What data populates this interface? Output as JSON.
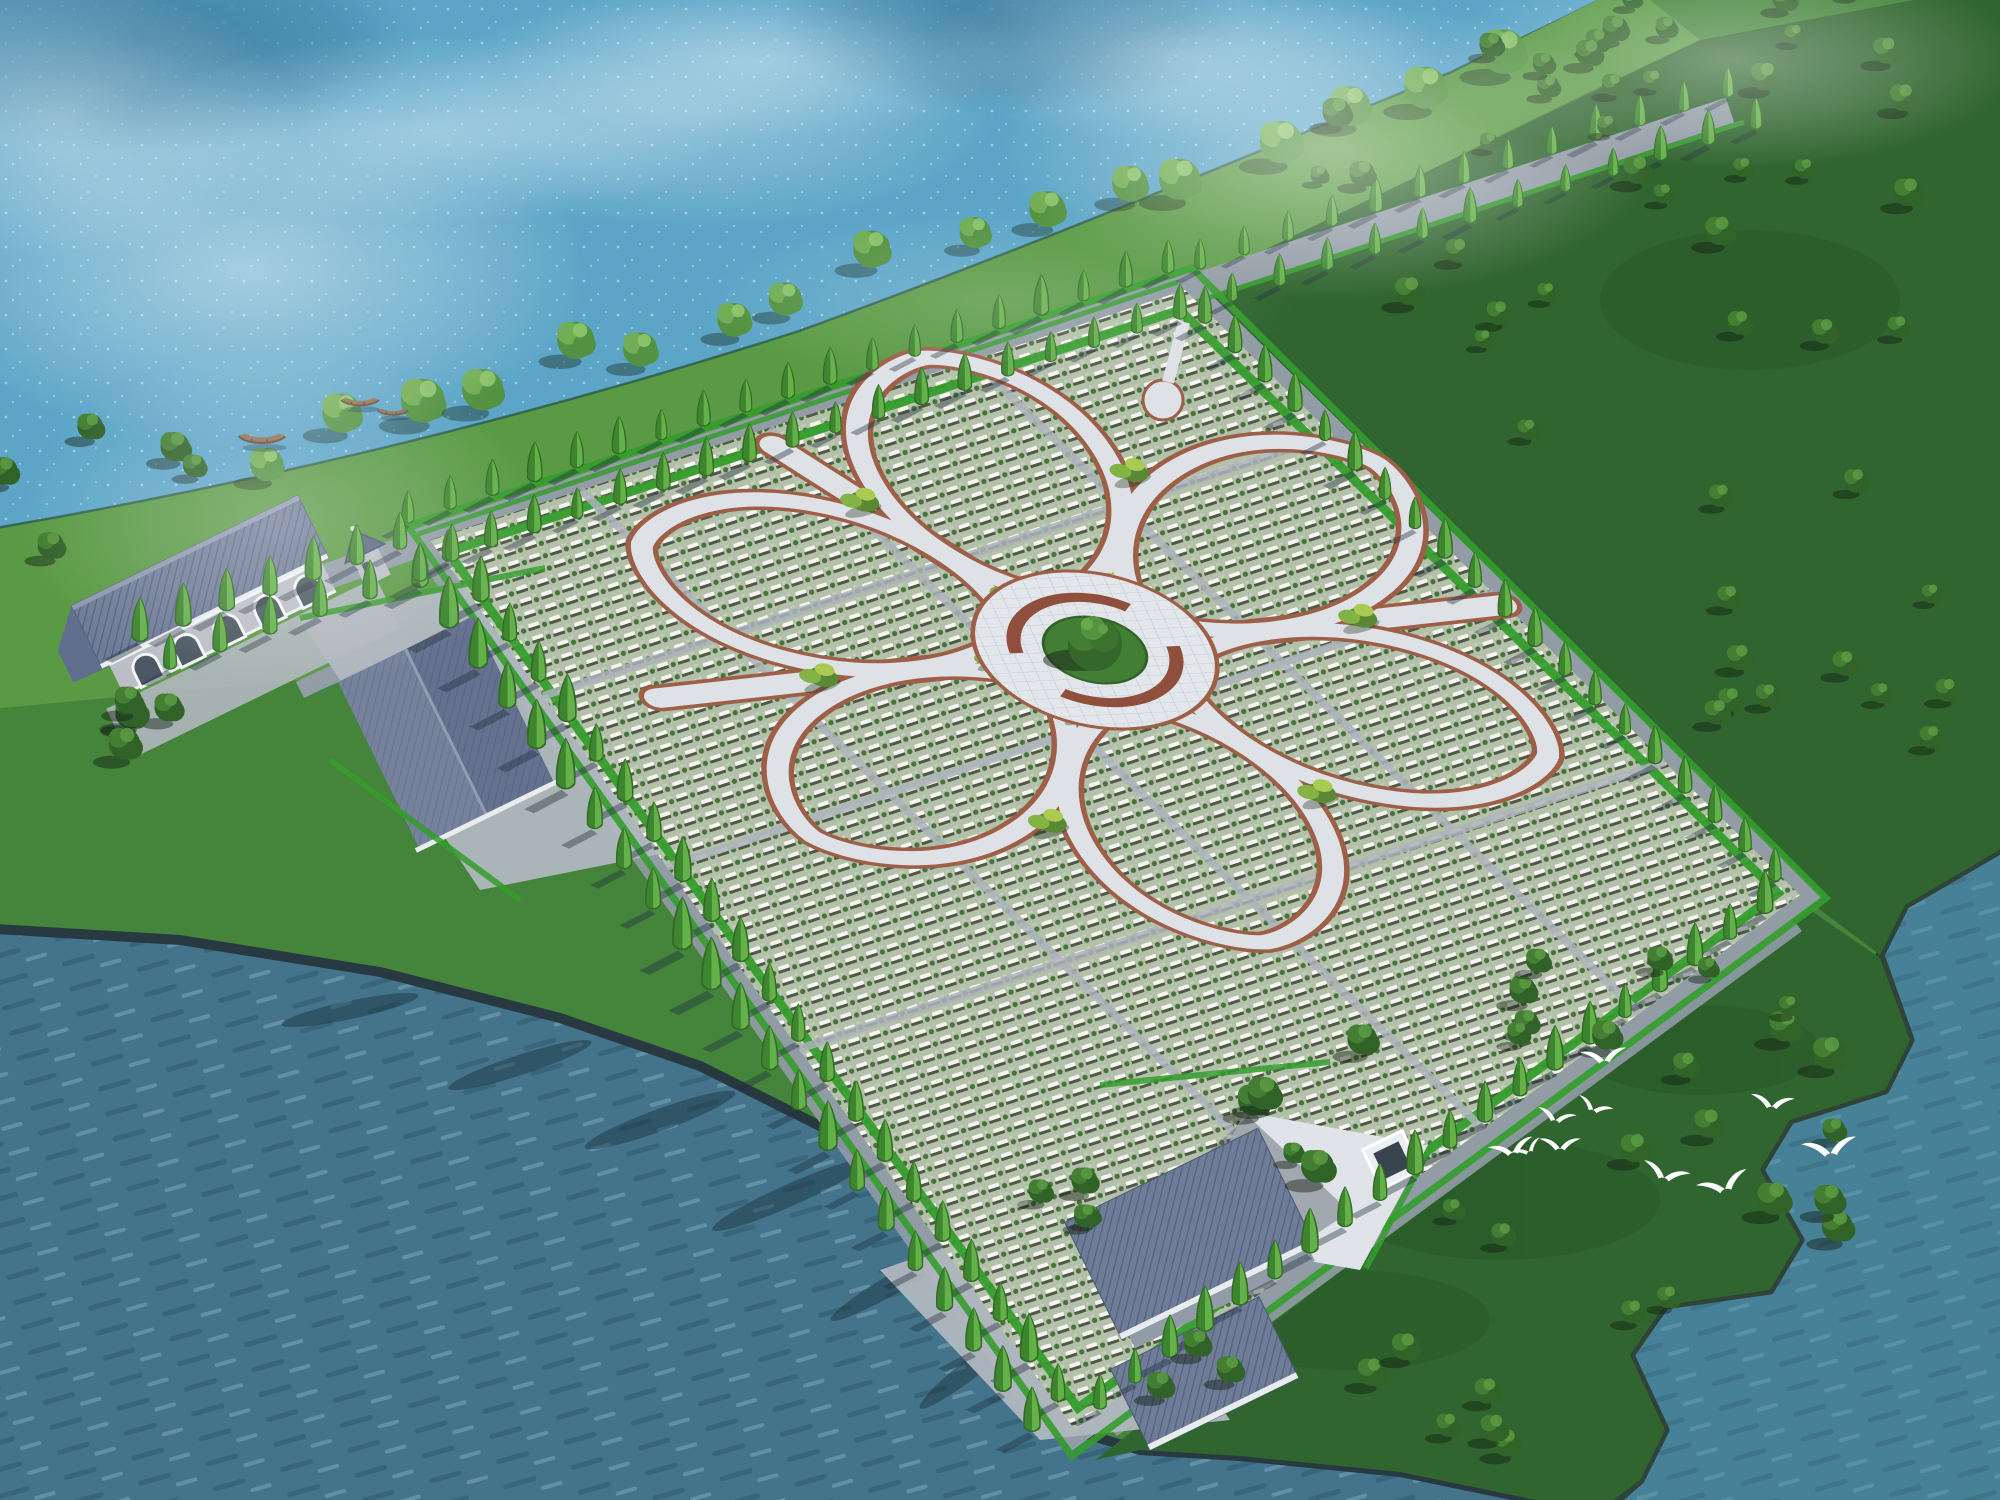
{
  "page": {
    "width": 2000,
    "height": 1500,
    "description": "Aerial 3D architectural rendering of a lakeside memorial park: a large diamond-shaped field of headstone rows with a six-petal flower path layout, circular central plaza with a memorial tree, perimeter roads lined with cypress trees, grey-roofed halls, boats on the lake and a flock of white egrets over the meadow"
  },
  "palette": {
    "water-light": "#58a3c6",
    "water-deep": "#3d7088",
    "water-teal": "#417d94",
    "land": "#3e8035",
    "grass-sunlit": "#55973f",
    "meadow-dark": "#2a6129",
    "field-base": "#b2bfa8",
    "stone-white": "#f3f5ee",
    "stone-shadow": "#26301f",
    "hedge": "#2f9a27",
    "cypress": "#3c8a2c",
    "cypress-dark": "#2c661f",
    "cypress-light": "#5fae44",
    "tree-dark": "#2b5e23",
    "tree-mid": "#3d7a2d",
    "tree-light": "#55963c",
    "shore-tree": "#4e8f3c",
    "shore-tree-light": "#6cab4e",
    "road": "#8e99a3",
    "path-light": "#dde2e7",
    "path-edge": "#9a5a42",
    "plaza-paving": "#e3e7eb",
    "planter": "#8d4937",
    "roof": "#6b7894",
    "roof-line": "#4f5c7a",
    "eave": "#e8ecef",
    "wall": "#b9bdc4",
    "window": "#46525e",
    "pave": "#aeb5bd",
    "court": "#dfe3e8",
    "boat": "#8a6a4a",
    "boat-dark": "#5e4430",
    "bird": "#ffffff",
    "coast-dark": "#22333b",
    "shoreline": "#2c5a50"
  },
  "features": {
    "flower_petals": 6,
    "central_plaza": "circular plaza with ring planters and one large memorial tree",
    "arched_windows_main_hall": 5,
    "bird_count": 10,
    "boat_count": 3,
    "water_bodies": [
      "calm lake upper left",
      "dark rippled river lower left",
      "bay lower right"
    ]
  },
  "scene_layout": {
    "cypress_rows": [
      {
        "x1": 408,
        "y1": 522,
        "x2": 1168,
        "y2": 272,
        "n": 19,
        "s": 0.95
      },
      {
        "x1": 448,
        "y1": 560,
        "x2": 1180,
        "y2": 318,
        "n": 18,
        "s": 0.9
      },
      {
        "x1": 1205,
        "y1": 322,
        "x2": 1775,
        "y2": 880,
        "n": 20,
        "s": 0.95
      },
      {
        "x1": 1200,
        "y1": 268,
        "x2": 1728,
        "y2": 96,
        "n": 13,
        "s": 0.85
      },
      {
        "x1": 1232,
        "y1": 300,
        "x2": 1756,
        "y2": 128,
        "n": 12,
        "s": 0.82
      },
      {
        "x1": 1765,
        "y1": 912,
        "x2": 1100,
        "y2": 1408,
        "n": 20,
        "s": 1.05
      },
      {
        "x1": 1058,
        "y1": 1400,
        "x2": 452,
        "y2": 560,
        "n": 22,
        "s": 1.12
      },
      {
        "x1": 1032,
        "y1": 1430,
        "x2": 420,
        "y2": 586,
        "n": 22,
        "s": 1.22
      },
      {
        "x1": 400,
        "y1": 548,
        "x2": 140,
        "y2": 640,
        "n": 7,
        "s": 1.1
      },
      {
        "x1": 420,
        "y1": 580,
        "x2": 170,
        "y2": 668,
        "n": 6,
        "s": 1.05
      }
    ],
    "shore_trees": {
      "x1": 260,
      "y1": 470,
      "x2": 1500,
      "y2": 90,
      "n": 17,
      "jitter": 18,
      "seed": 5,
      "smin": 1.15,
      "smax": 1.75
    },
    "tree_clusters": [
      {
        "cx": 1630,
        "cy": 240,
        "rx": 360,
        "ry": 210,
        "n": 26,
        "seed": 7,
        "smin": 0.8,
        "smax": 1.3
      },
      {
        "cx": 1845,
        "cy": 620,
        "rx": 160,
        "ry": 230,
        "n": 12,
        "seed": 11,
        "smin": 0.8,
        "smax": 1.2
      },
      {
        "cx": 1800,
        "cy": 60,
        "rx": 230,
        "ry": 80,
        "n": 10,
        "seed": 61,
        "smin": 0.8,
        "smax": 1.2
      },
      {
        "cx": 1565,
        "cy": 1130,
        "rx": 320,
        "ry": 215,
        "n": 26,
        "seed": 23,
        "smin": 0.9,
        "smax": 1.5
      },
      {
        "cx": 1300,
        "cy": 1420,
        "rx": 240,
        "ry": 80,
        "n": 9,
        "seed": 31,
        "smin": 0.9,
        "smax": 1.3
      },
      {
        "cx": 120,
        "cy": 500,
        "rx": 130,
        "ry": 70,
        "n": 5,
        "seed": 41,
        "smin": 1.0,
        "smax": 1.5
      },
      {
        "cx": 100,
        "cy": 720,
        "rx": 130,
        "ry": 80,
        "n": 5,
        "seed": 43,
        "smin": 1.0,
        "smax": 1.5
      },
      {
        "cx": 1015,
        "cy": 1205,
        "rx": 90,
        "ry": 55,
        "n": 4,
        "seed": 53,
        "smin": 0.9,
        "smax": 1.2
      }
    ],
    "mist_patches": [
      {
        "cx": 250,
        "cy": 270,
        "rx": 340,
        "ry": 180,
        "o": 0.5
      },
      {
        "cx": 700,
        "cy": 110,
        "rx": 300,
        "ry": 120,
        "o": 0.35
      },
      {
        "cx": 1330,
        "cy": 150,
        "rx": 330,
        "ry": 150,
        "o": 0.5
      },
      {
        "cx": 1180,
        "cy": 55,
        "rx": 260,
        "ry": 90,
        "o": 0.4
      },
      {
        "cx": 280,
        "cy": 520,
        "rx": 260,
        "ry": 170,
        "o": 0.3
      },
      {
        "cx": 1730,
        "cy": 60,
        "rx": 290,
        "ry": 110,
        "o": 0.42
      },
      {
        "cx": 60,
        "cy": 120,
        "rx": 240,
        "ry": 140,
        "o": 0.45
      },
      {
        "cx": 1000,
        "cy": 300,
        "rx": 300,
        "ry": 90,
        "o": 0.18
      }
    ]
  },
  "wildlife": {
    "birds": [
      {
        "x": 1512,
        "y": 1150,
        "s": 1.0,
        "r": -14
      },
      {
        "x": 1556,
        "y": 1118,
        "s": 0.85,
        "r": 12
      },
      {
        "x": 1604,
        "y": 1058,
        "s": 1.0,
        "r": -6
      },
      {
        "x": 1594,
        "y": 1108,
        "s": 0.8,
        "r": 22
      },
      {
        "x": 1560,
        "y": 1146,
        "s": 0.9,
        "r": 0
      },
      {
        "x": 1528,
        "y": 1150,
        "s": 0.7,
        "r": -28
      },
      {
        "x": 1665,
        "y": 1175,
        "s": 1.05,
        "r": 16
      },
      {
        "x": 1724,
        "y": 1186,
        "s": 1.15,
        "r": -18
      },
      {
        "x": 1772,
        "y": 1104,
        "s": 0.95,
        "r": 6
      },
      {
        "x": 1830,
        "y": 1150,
        "s": 1.2,
        "r": -8
      }
    ]
  },
  "boats": [
    {
      "x": 262,
      "y": 440,
      "s": 1.3
    },
    {
      "x": 360,
      "y": 403,
      "s": 1.05
    },
    {
      "x": 393,
      "y": 413,
      "s": 0.85
    }
  ]
}
